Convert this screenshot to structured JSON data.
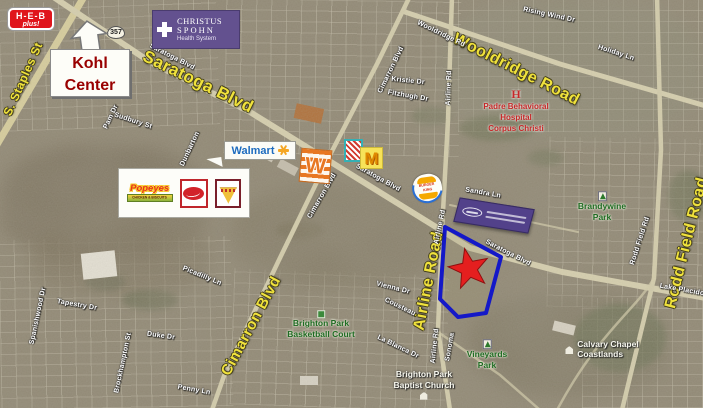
{
  "roads_major": {
    "saratoga": "Saratoga Blvd",
    "wooldridge": "Wooldridge Road",
    "airline": "Airline Road",
    "rodd_field": "Rodd Field Road",
    "cimarron": "Cimarron Blvd",
    "staples": "S. Staples St"
  },
  "streets": {
    "saratoga_1": "Saratoga Blvd",
    "saratoga_2": "Saratoga Blvd",
    "saratoga_3": "Saratoga Blvd",
    "cimarron_1": "Cimarron Blvd",
    "cimarron_2": "Cimarron Blvd",
    "airline_1": "Airline Rd",
    "airline_2": "Airline Rd",
    "airline_3": "Airline Rd",
    "wooldridge_sm": "Wooldridge Rd",
    "rodd_field_sm": "Rodd Field Rd",
    "sandra": "Sandra Ln",
    "fitzhugh": "Fitzhugh Dr",
    "kristie": "Kristie Dr",
    "rising_wind": "Rising Wind Dr",
    "holiday": "Holiday Ln",
    "tapestry": "Tapestry Dr",
    "brockhampton": "Brockhampton St",
    "duke": "Duke Dr",
    "penny": "Penny Ln",
    "picadilly": "Picadilly Ln",
    "la_blanca": "La Blanca Dr",
    "cousteau": "Cousteau",
    "vienna": "Vienna Dr",
    "sonoma": "Sonoma",
    "lake_placido": "Lake Placido",
    "pam": "Pam Dr",
    "sudbury": "Sudbury St",
    "dunbarton": "Dunbarton",
    "spanishwood": "Spanishwood Dr"
  },
  "parks": {
    "brandywine": [
      "Brandywine",
      "Park"
    ],
    "vineyards": [
      "Vineyards",
      "Park"
    ],
    "brighton_bb": [
      "Brighton Park",
      "Basketball Court"
    ]
  },
  "places": {
    "brighton_church": [
      "Brighton Park",
      "Baptist Church"
    ],
    "calvary": [
      "Calvary Chapel",
      "Coastlands"
    ],
    "padre_marker": "H",
    "padre": [
      "Padre Behavioral",
      "Hospital",
      "Corpus Christi"
    ]
  },
  "signs": {
    "heb": {
      "name": "H-E-B",
      "sub": "plus!"
    },
    "route_shield": "357",
    "kohl": {
      "line1": "Kohl",
      "line2": "Center"
    },
    "christus": {
      "line1": "CHRISTUS",
      "line2": "SPOHN",
      "line3": "Health System"
    },
    "walmart": {
      "name": "Walmart"
    },
    "popeyes": {
      "name": "Popeyes",
      "sub": "CHICKEN & BISCUITS"
    },
    "burger_king": {
      "line1": "BURGER",
      "line2": "KING"
    },
    "mcdonalds": "M",
    "whataburger": "W"
  },
  "icons": {
    "star": "red-star-marker",
    "parcel": "blue-parcel-outline",
    "walmart_spark": "walmart-spark-icon",
    "dairy_queen": "dairy-queen-ellipse-logo",
    "pizza_fan": "pizza-fan-logo",
    "red_stripes": "red-stripes-logo",
    "purple_banner": "purple-sign-banner",
    "kohl_arrow": "up-arrow-icon",
    "park_tree": "park-tree-icon",
    "church": "church-icon",
    "basketball": "basketball-court-icon",
    "christus_cross": "health-cross-icon"
  },
  "colors": {
    "road_label_yellow": "#f0e23c",
    "street_label_white": "#ffffff",
    "park_green": "#1e6b22",
    "hospital_red": "#c62828",
    "star_red": "#e41f1f",
    "parcel_blue": "#1418c8",
    "heb_red": "#e0151c",
    "christus_purple": "#63518f",
    "walmart_blue": "#1c6bbf",
    "kohl_red": "#990000",
    "whataburger_orange": "#e87722",
    "banner_purple": "#52418a"
  }
}
